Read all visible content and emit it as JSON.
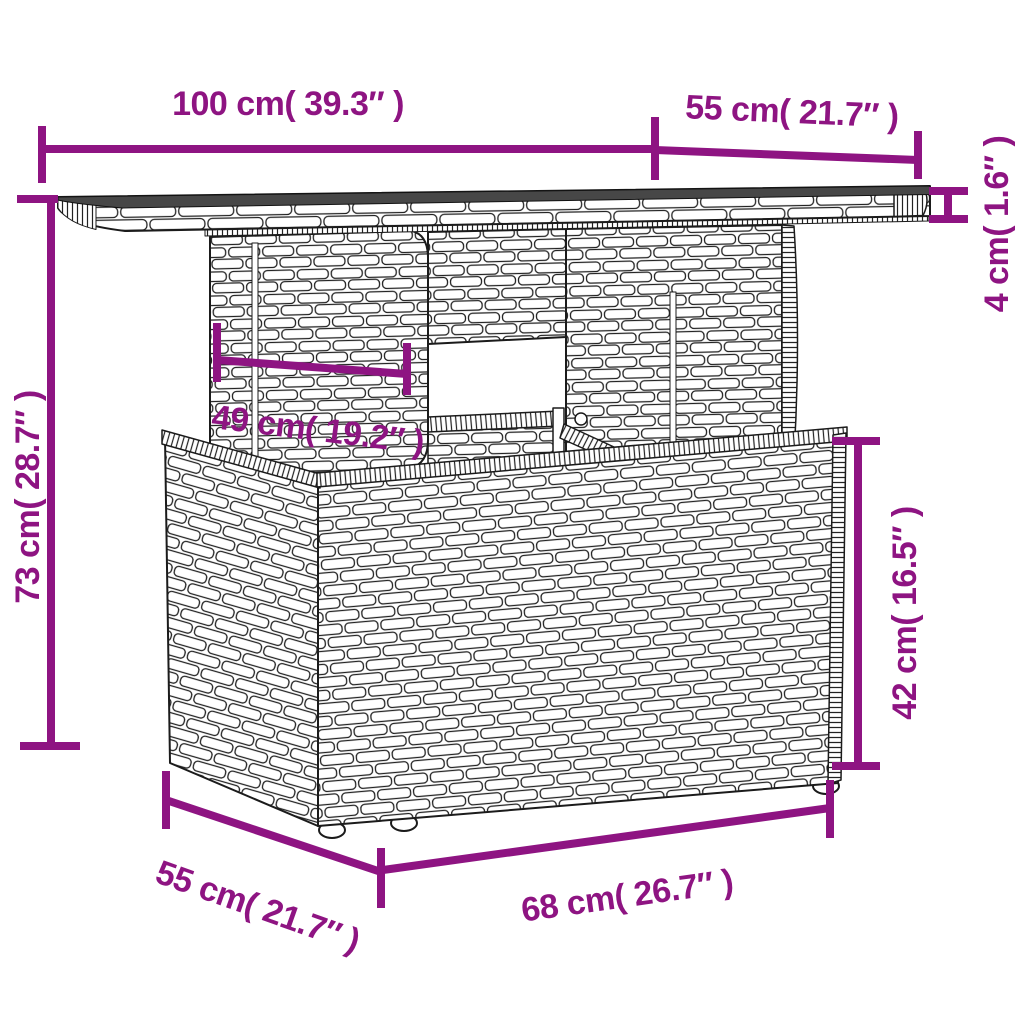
{
  "illustration": {
    "subject": "poly-rattan-pedestal-table-line-drawing",
    "colors": {
      "dimension_accent": "#8E1482",
      "line_art": "#1B1B1B",
      "tabletop_surface": "#474747",
      "background": "#FFFFFF"
    }
  },
  "dims": {
    "top_width": {
      "label": "100 cm( 39.3″ )",
      "cm": 100,
      "inches": 39.3
    },
    "top_depth": {
      "label": "55 cm( 21.7″ )",
      "cm": 55,
      "inches": 21.7
    },
    "top_thickness": {
      "label": "4 cm( 1.6″ )",
      "cm": 4,
      "inches": 1.6
    },
    "overall_height": {
      "label": "73 cm( 28.7″ )",
      "cm": 73,
      "inches": 28.7
    },
    "pedestal_width": {
      "label": "49 cm( 19.2″ )",
      "cm": 49,
      "inches": 19.2
    },
    "base_height": {
      "label": "42 cm( 16.5″ )",
      "cm": 42,
      "inches": 16.5
    },
    "base_depth": {
      "label": "55 cm( 21.7″ )",
      "cm": 55,
      "inches": 21.7
    },
    "base_width": {
      "label": "68 cm( 26.7″ )",
      "cm": 68,
      "inches": 26.7
    }
  }
}
